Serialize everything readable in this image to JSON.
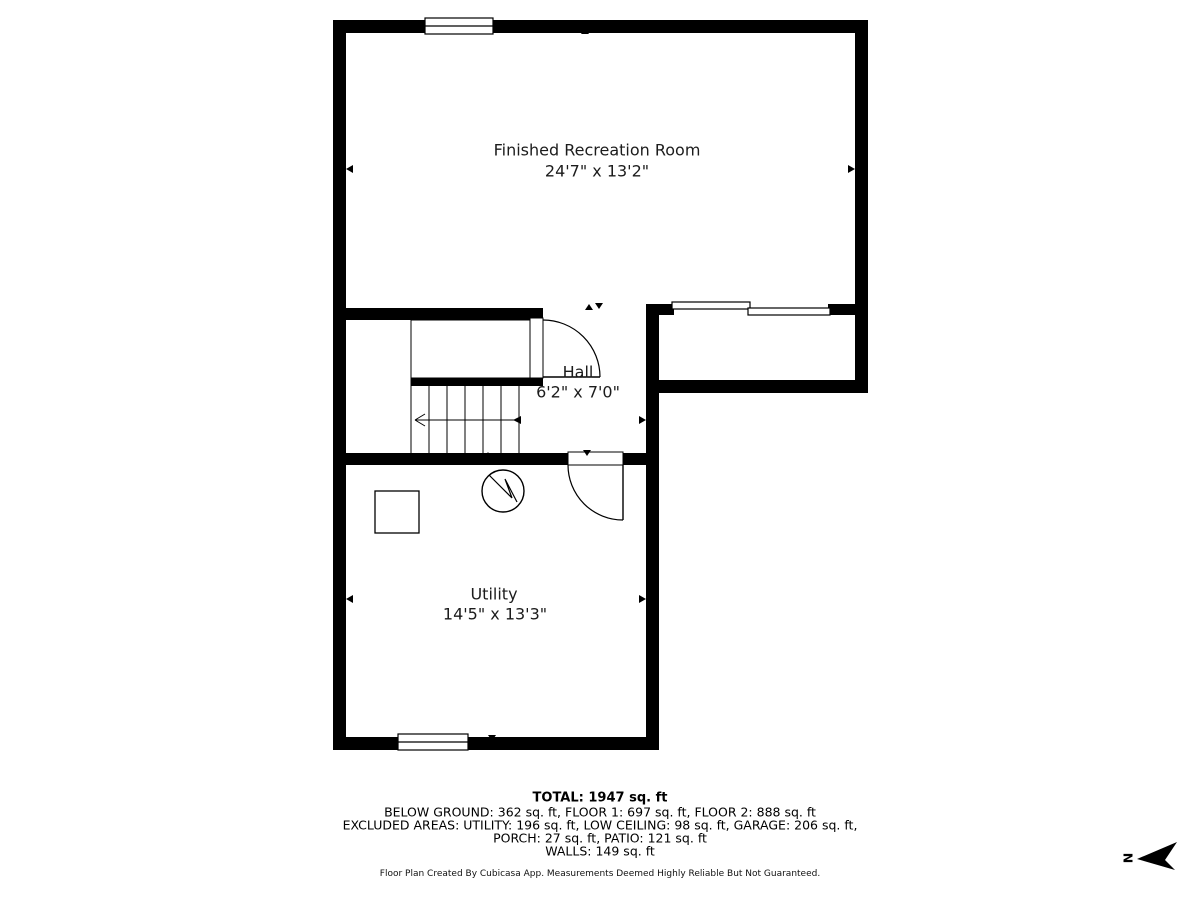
{
  "rooms": [
    {
      "name": "Finished Recreation Room",
      "dims": "24'7\" x 13'2\""
    },
    {
      "name": "Hall",
      "dims": "6'2\" x 7'0\""
    },
    {
      "name": "Utility",
      "dims": "14'5\" x 13'3\""
    }
  ],
  "summary": {
    "total": "TOTAL: 1947 sq. ft",
    "floors": "BELOW GROUND: 362 sq. ft, FLOOR 1: 697 sq. ft, FLOOR 2: 888 sq. ft",
    "excluded": "EXCLUDED AREAS: UTILITY: 196 sq. ft, LOW CEILING: 98 sq. ft, GARAGE: 206 sq. ft,",
    "excluded2": "PORCH: 27 sq. ft, PATIO: 121 sq. ft",
    "walls": "WALLS: 149 sq. ft"
  },
  "footer": {
    "disclaimer": "Floor Plan Created By Cubicasa App. Measurements Deemed Highly Reliable But Not Guaranteed."
  },
  "compass": {
    "north_label": "N"
  },
  "colors": {
    "wall": "#000000",
    "background": "#ffffff",
    "text": "#1c1c1c"
  }
}
